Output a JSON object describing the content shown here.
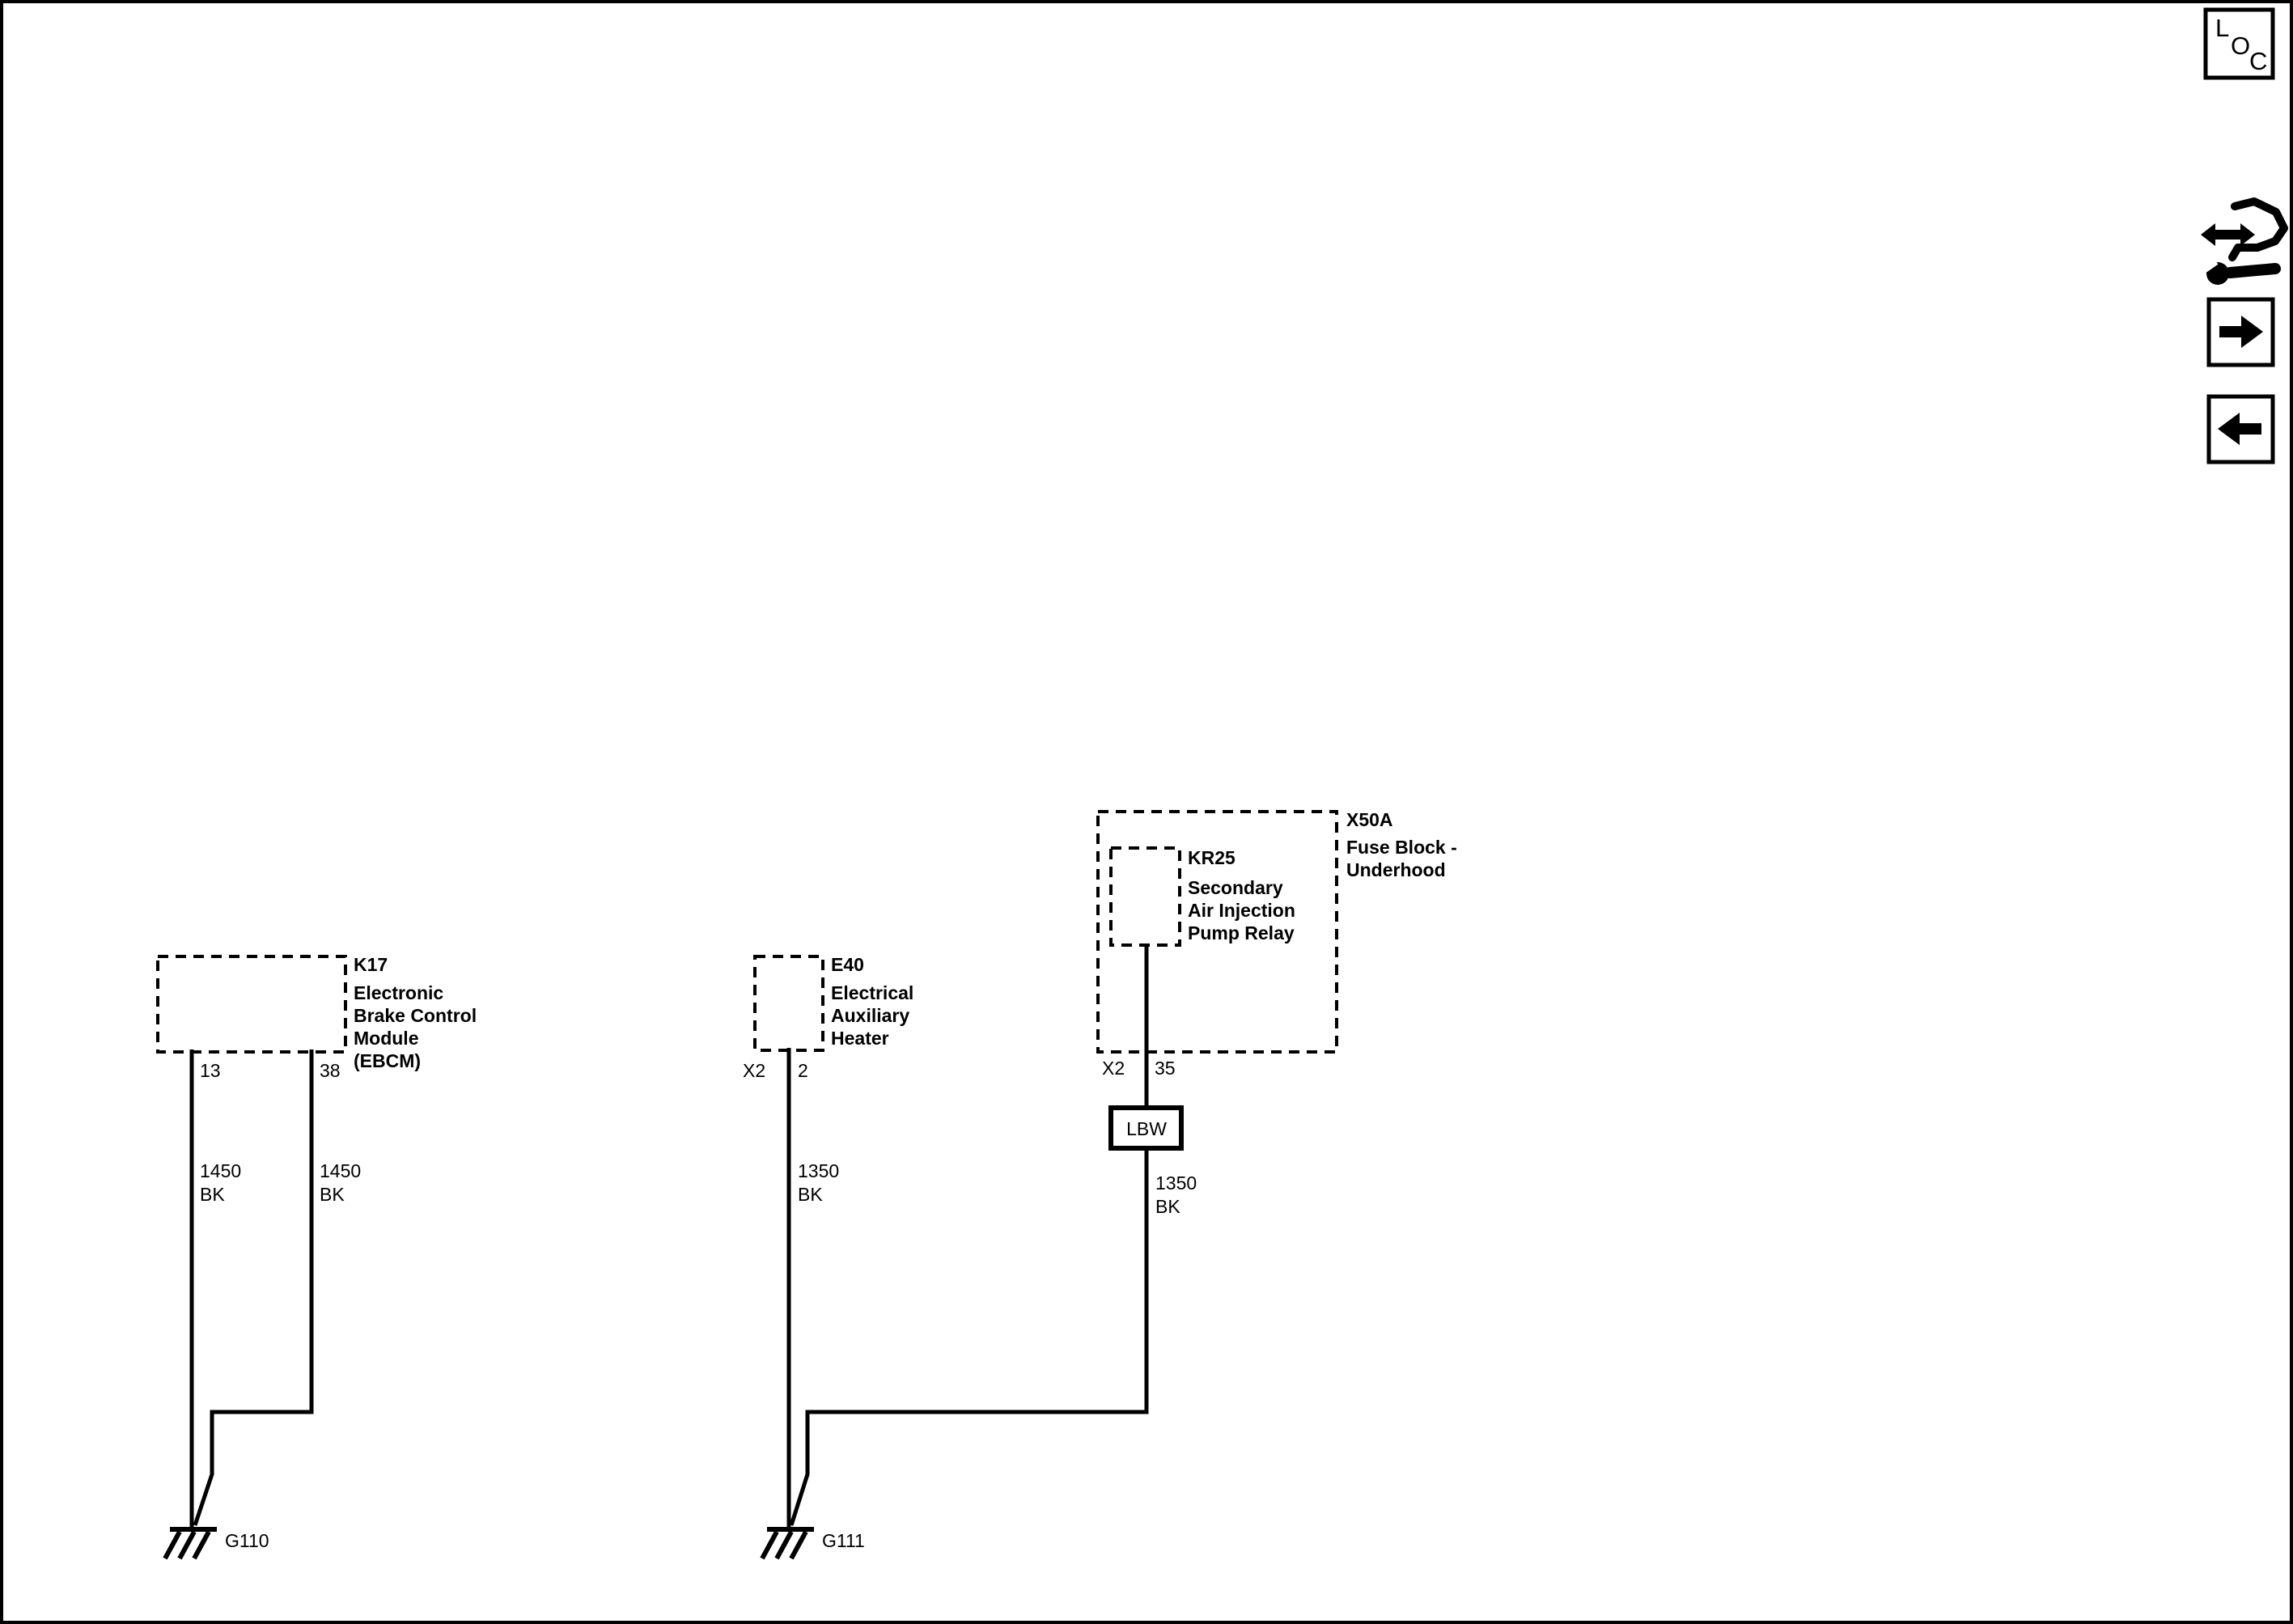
{
  "diagram": {
    "background": "#ffffff",
    "line_color": "#000000"
  },
  "controls": {
    "loc_button": {
      "icon": "loc-icon",
      "letters": [
        "L",
        "O",
        "C"
      ]
    },
    "nav_icon": "wrench-double-arrow-icon",
    "forward_button_icon": "arrow-right-icon",
    "back_button_icon": "arrow-left-icon"
  },
  "components": {
    "k17": {
      "id": "K17",
      "name_lines": [
        "Electronic",
        "Brake Control",
        "Module",
        "(EBCM)"
      ],
      "pins": [
        "13",
        "38"
      ]
    },
    "e40": {
      "id": "E40",
      "name_lines": [
        "Electrical",
        "Auxiliary",
        "Heater"
      ],
      "connector": "X2",
      "pin": "2"
    },
    "x50a": {
      "id": "X50A",
      "name_lines": [
        "Fuse Block -",
        "Underhood"
      ],
      "connector": "X2",
      "pin": "35"
    },
    "kr25": {
      "id": "KR25",
      "name_lines": [
        "Secondary",
        "Air Injection",
        "Pump Relay"
      ]
    }
  },
  "splice": {
    "label": "LBW"
  },
  "wires": {
    "k17_pin13": {
      "circuit": "1450",
      "color": "BK"
    },
    "k17_pin38": {
      "circuit": "1450",
      "color": "BK"
    },
    "e40_pin2": {
      "circuit": "1350",
      "color": "BK"
    },
    "kr25_pin35": {
      "circuit": "1350",
      "color": "BK"
    }
  },
  "grounds": {
    "g110": "G110",
    "g111": "G111"
  }
}
